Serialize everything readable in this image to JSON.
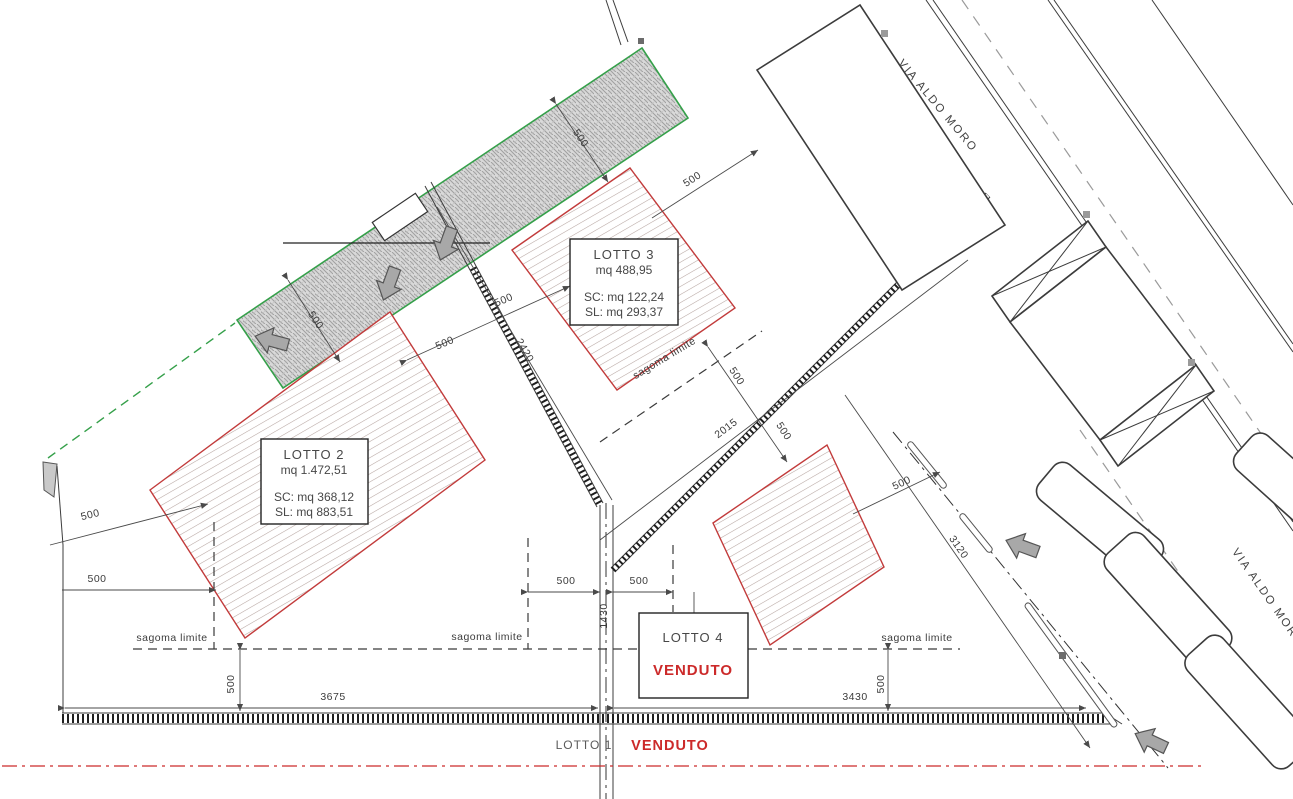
{
  "plan": {
    "boundary_label": "sagoma limite",
    "streets": {
      "main": "VIA ALDO MORO",
      "secondary": "VIA ALDO MOR"
    },
    "lot1": {
      "name": "LOTTO 1",
      "status": "VENDUTO"
    },
    "boxes": {
      "lotto2": {
        "title": "LOTTO 2",
        "area": "mq 1.472,51",
        "sc": "SC: mq 368,12",
        "sl": "SL: mq 883,51"
      },
      "lotto3": {
        "title": "LOTTO 3",
        "area": "mq 488,95",
        "sc": "SC: mq 122,24",
        "sl": "SL: mq 293,37"
      },
      "lotto4": {
        "title": "LOTTO 4",
        "status": "VENDUTO"
      }
    },
    "dims": [
      "500",
      "500",
      "500",
      "500",
      "500",
      "2420",
      "500",
      "2015",
      "500",
      "500",
      "3120",
      "500",
      "500",
      "500",
      "500",
      "1430",
      "500",
      "3675",
      "3430",
      "500"
    ],
    "colors": {
      "sold_red": "#cc2a2a",
      "lot_outline": "#c23b3b",
      "green_boundary": "#35a04a"
    }
  }
}
